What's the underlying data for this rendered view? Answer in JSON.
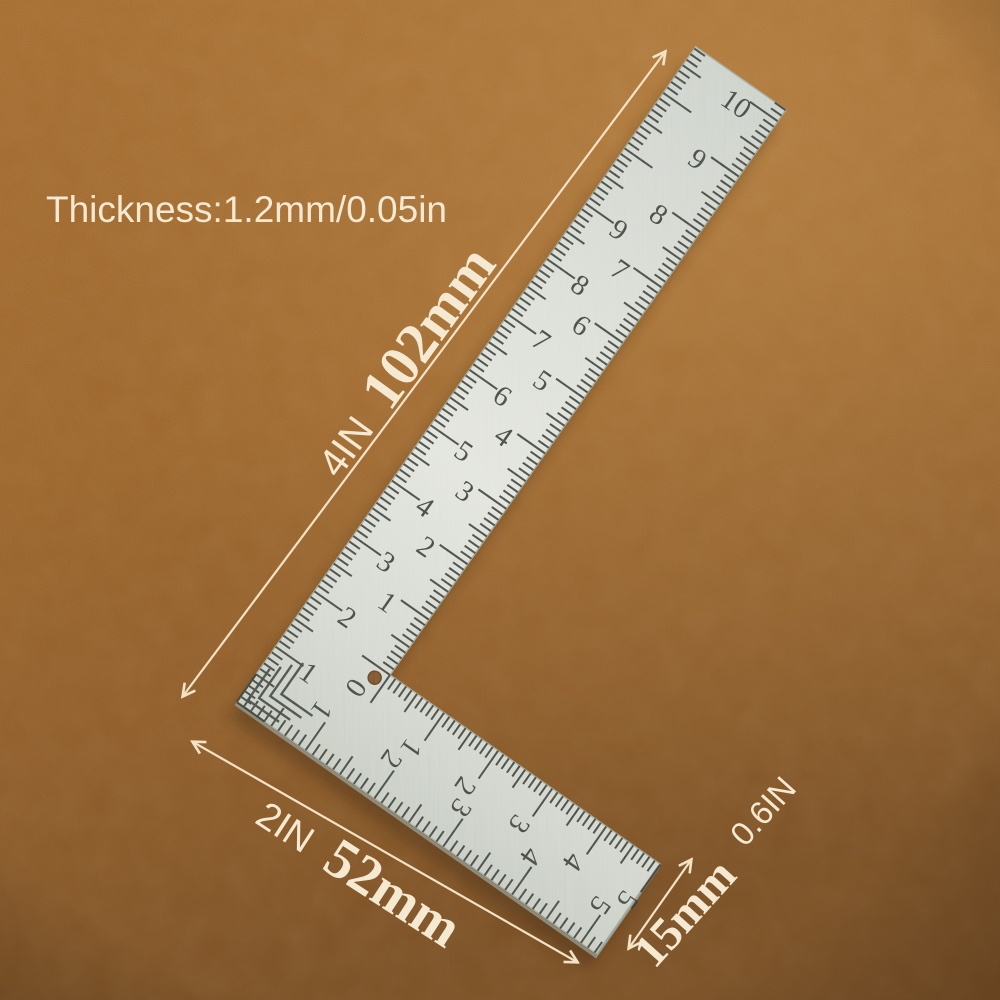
{
  "product_photo": {
    "subject": "L-shaped 90-degree steel square ruler lying on brown leather background",
    "annotations": {
      "thickness_label": "Thickness:1.2mm/0.05in",
      "long_arm_inches": "4IN",
      "long_arm_mm": "102mm",
      "short_arm_inches": "2IN",
      "short_arm_mm": "52mm",
      "width_mm": "15mm",
      "width_inches": "0.6IN"
    },
    "ruler": {
      "corner_zero": "0",
      "long_arm_inner_numbers": [
        "0",
        "1",
        "2",
        "3",
        "4",
        "5",
        "6",
        "7",
        "8",
        "9",
        "10"
      ],
      "long_arm_outer_numbers": [
        "1",
        "2",
        "3",
        "4",
        "5",
        "6",
        "7",
        "8",
        "9"
      ],
      "short_arm_inner_numbers": [
        "1",
        "2",
        "3",
        "4",
        "5"
      ],
      "short_arm_outer_numbers": [
        "1",
        "2",
        "3",
        "4",
        "5"
      ]
    },
    "colors": {
      "background_top": "#b37535",
      "background_mid": "#a86c30",
      "background_bottom": "#7f5126",
      "annotation_text": "#f6e9d2",
      "arrow": "#f3e3c6",
      "ruler_metal": "#dbded7",
      "ruler_markings": "#3f443d"
    }
  }
}
